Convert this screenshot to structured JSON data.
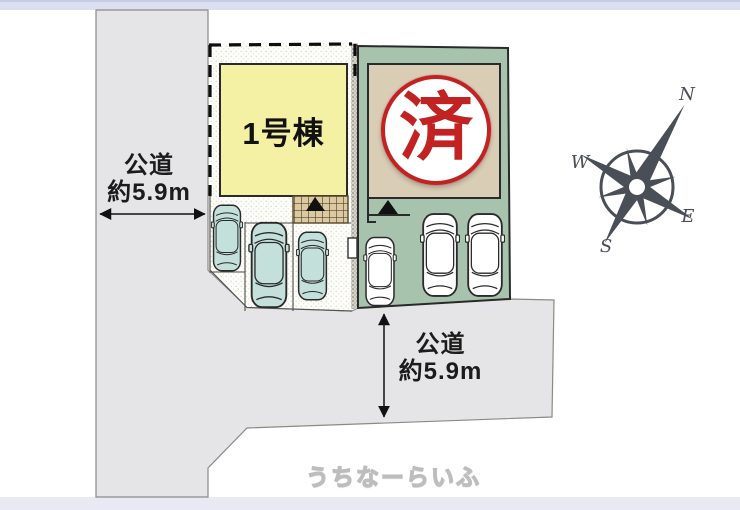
{
  "plots": {
    "left": {
      "building_label": "1号棟"
    },
    "right": {
      "stamp_label": "済"
    }
  },
  "roads": {
    "left_road": {
      "name": "公道",
      "width": "約5.9m"
    },
    "bottom_road": {
      "name": "公道",
      "width": "約5.9m"
    }
  },
  "compass": {
    "north": "N",
    "south": "S",
    "east": "E",
    "west": "W"
  },
  "watermark": {
    "text": "うちなーらいふ"
  },
  "colors": {
    "road": "#e5e5e7",
    "plot_green": "#a7c3ad",
    "building_yellow": "#f4f0a4",
    "building_beige": "#d9cdb5",
    "stamp_red": "#c32222",
    "car_teal": "#c3e0da",
    "compass": "#4a4e57",
    "band_top": "#dcdff0",
    "band_bottom": "#e9e9f4"
  }
}
